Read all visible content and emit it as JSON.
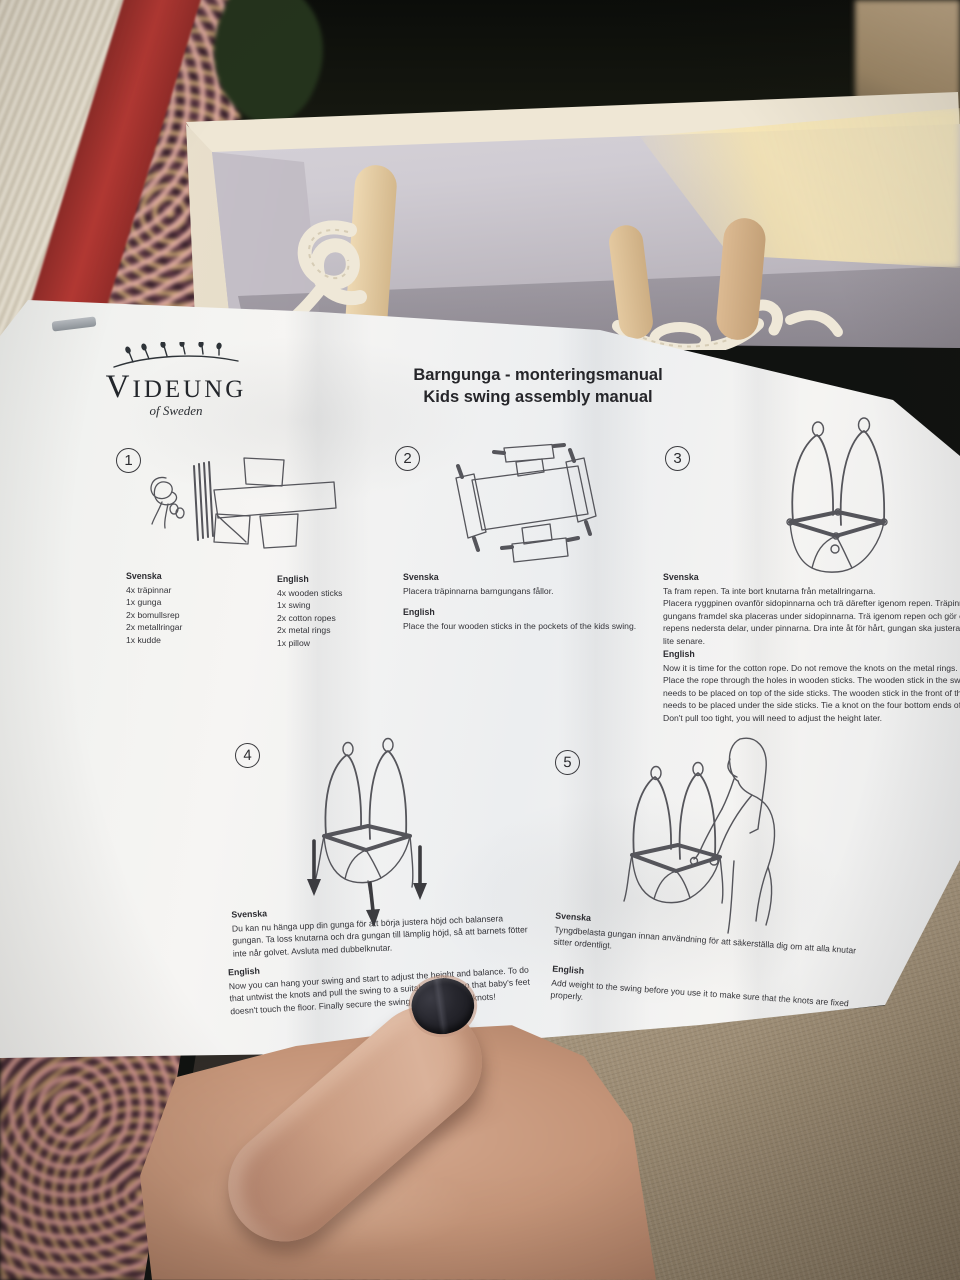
{
  "logo": {
    "name": "VIDEUNG",
    "tagline": "of Sweden",
    "mark": "willow-branch-icon"
  },
  "title": {
    "line1": "Barngunga - monteringsmanual",
    "line2": "Kids swing assembly manual"
  },
  "steps": [
    {
      "number": "1",
      "illustration": "swing-parts-drawing",
      "columns": [
        {
          "heading": "Svenska",
          "items": [
            "4x träpinnar",
            "1x gunga",
            "2x bomullsrep",
            "2x metallringar",
            "1x kudde"
          ]
        },
        {
          "heading": "English",
          "items": [
            "4x wooden sticks",
            "1x swing",
            "2x cotton ropes",
            "2x metal rings",
            "1x pillow"
          ]
        }
      ]
    },
    {
      "number": "2",
      "illustration": "sticks-in-pockets-drawing",
      "svenska": {
        "heading": "Svenska",
        "text": "Placera träpinnarna barngungans fållor."
      },
      "english": {
        "heading": "English",
        "text": "Place the four wooden sticks in the pockets of the kids swing."
      }
    },
    {
      "number": "3",
      "illustration": "assembled-swing-drawing",
      "svenska": {
        "heading": "Svenska",
        "text": "Ta fram repen. Ta inte bort knutarna från metallringarna.\nPlacera ryggpinen ovanför sidopinnarna och trä därefter igenom repen. Träpinnen\ngungans framdel ska placeras under sidopinnarna. Trä igenom repen och gör en\nrepens nedersta delar, under pinnarna. Dra inte åt för hårt, gungan ska justeras\nlite senare."
      },
      "english": {
        "heading": "English",
        "text": "Now it is time for the cotton rope. Do not remove the knots on the metal rings.\nPlace the rope through the holes in wooden sticks. The wooden stick in the swing\nneeds to be placed on top of the side sticks. The wooden stick in the front of the\nneeds to be placed under the side sticks. Tie a knot on the four bottom ends of the\nDon't pull too tight, you will need to adjust the height later."
      }
    },
    {
      "number": "4",
      "illustration": "adjust-height-drawing",
      "svenska": {
        "heading": "Svenska",
        "text": "Du kan nu hänga upp din gunga för att börja justera höjd och balansera\ngungan. Ta loss knutarna och dra gungan till lämplig höjd, så att barnets fötter\ninte når golvet. Avsluta med dubbelknutar."
      },
      "english": {
        "heading": "English",
        "text": "Now you can hang your swing and start to adjust the height and balance. To do\nthat untwist the knots and pull the swing to a suitable height, so that baby's feet\ndoesn't touch the floor. Finally secure the swing by tying double knots!"
      }
    },
    {
      "number": "5",
      "illustration": "weight-test-drawing",
      "svenska": {
        "heading": "Svenska",
        "text": "Tyngdbelasta gungan innan användning för att säkerställa dig om att alla knutar\nsitter ordentligt."
      },
      "english": {
        "heading": "English",
        "text": "Add weight to the swing before you use it to make sure that the knots are fixed\nproperly."
      }
    }
  ],
  "colors": {
    "paper": "#f4f3f1",
    "ink": "#2e2e31",
    "rug_red": "#a63030",
    "wood": "#e0c49c",
    "rope": "#efe8d8",
    "skin": "#c89a83",
    "nail_polish": "#1d1d23",
    "linen": "#a79881",
    "box_interior": "#d5d1d7"
  }
}
